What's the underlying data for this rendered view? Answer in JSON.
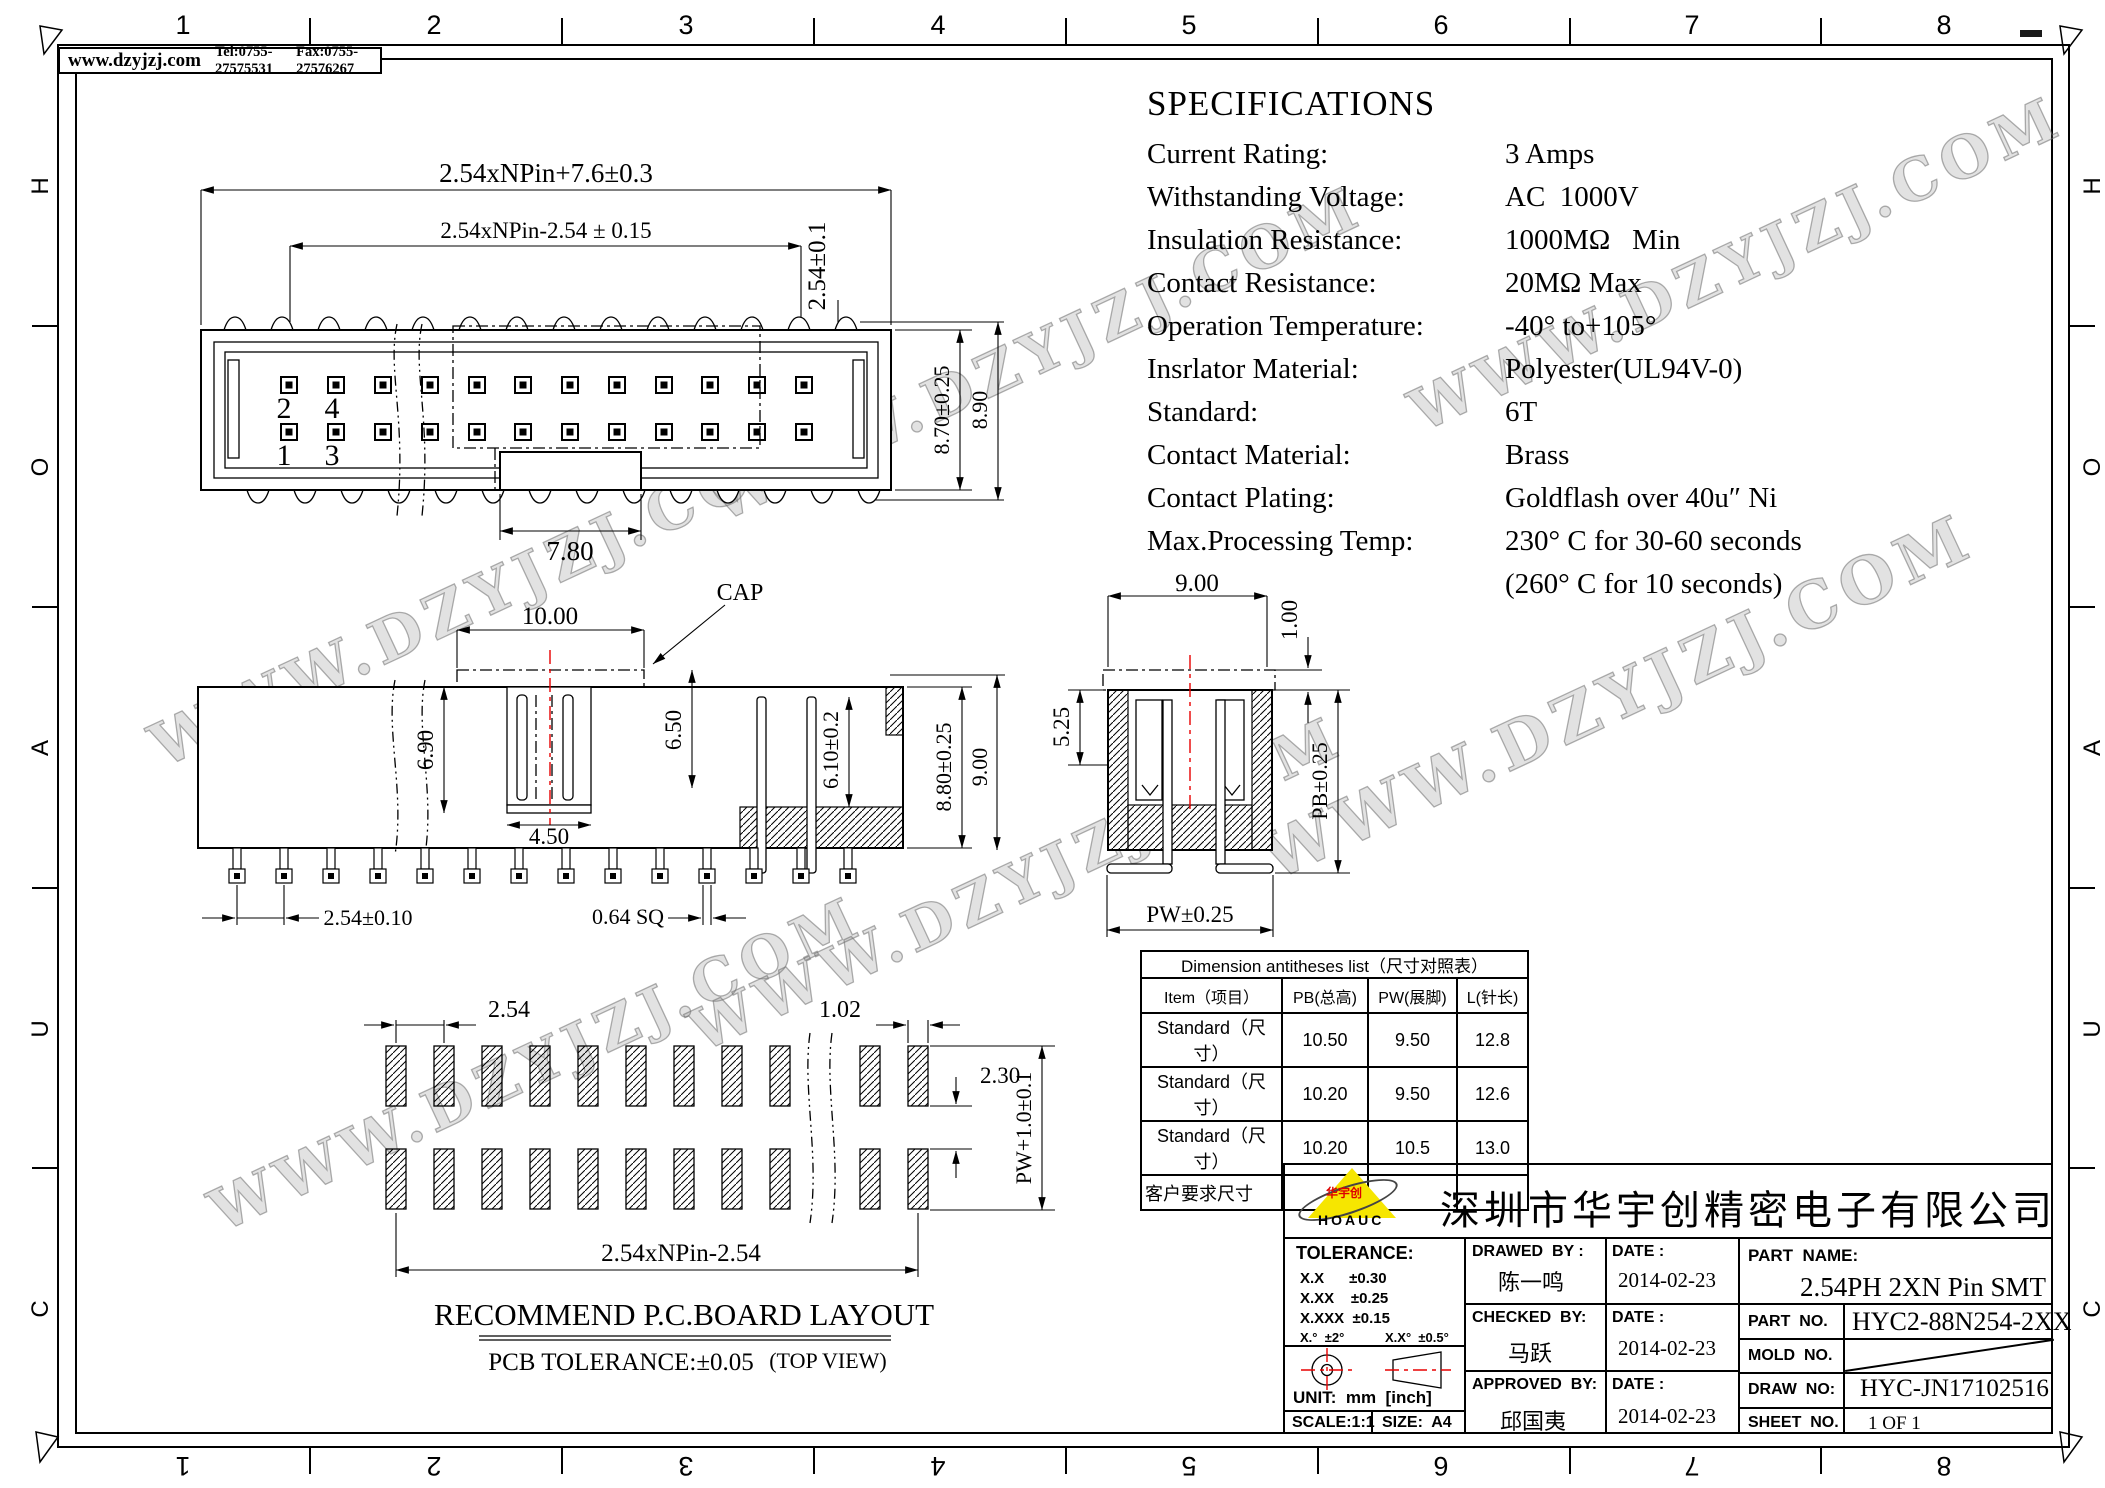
{
  "header": {
    "website": "www.dzyjzj.com",
    "tel": "Tel:0755-27575531",
    "fax": "Fax:0755-27576267"
  },
  "frame": {
    "top_numbers": [
      "1",
      "2",
      "3",
      "4",
      "5",
      "6",
      "7",
      "8"
    ],
    "bottom_numbers": [
      "8",
      "7",
      "6",
      "5",
      "4",
      "3",
      "2",
      "1"
    ],
    "left_letters": [
      "H",
      "O",
      "A",
      "U",
      "C"
    ],
    "right_let": [
      "H",
      "O",
      "A",
      "U",
      "C"
    ]
  },
  "watermark": {
    "text": "WWW.DZYJZJ.COM"
  },
  "specs": {
    "title": "SPECIFICATIONS",
    "rows": [
      {
        "label": "Current Rating:",
        "value": "3 Amps"
      },
      {
        "label": "Withstanding Voltage:",
        "value": "AC  1000V"
      },
      {
        "label": "Insulation Resistance:",
        "value": "1000MΩ   Min"
      },
      {
        "label": "Contact Resistance:",
        "value": "20MΩ Max"
      },
      {
        "label": "Operation Temperature:",
        "value": "-40° to+105°"
      },
      {
        "label": "Insrlator Material:",
        "value": "Polyester(UL94V-0)"
      },
      {
        "label": "Standard:",
        "value": "6T"
      },
      {
        "label": "Contact Material:",
        "value": "Brass"
      },
      {
        "label": "Contact Plating:",
        "value": "Goldflash over 40u″ Ni"
      },
      {
        "label": "Max.Processing Temp:",
        "value": "230° C for 30-60 seconds"
      },
      {
        "label": "",
        "value": "(260° C for 10 seconds)"
      }
    ]
  },
  "top_view": {
    "d_total": "2.54xNPin+7.6±0.3",
    "d_inner": "2.54xNPin-2.54 ± 0.15",
    "d_row_pitch": "2.54±0.1",
    "d_body_h": "8.70±0.25",
    "d_total_h": "8.90",
    "d_tab": "7.80",
    "pins": [
      "2",
      "4",
      "1",
      "3"
    ]
  },
  "side_view": {
    "cap_label": "CAP",
    "d_cap_w": "10.00",
    "d_inner_h": "6.90",
    "d_cap_h": "6.50",
    "d_key_w": "4.50",
    "d_cavity_h": "6.10±0.2",
    "d_body_h": "8.80±0.25",
    "d_total_h": "9.00",
    "d_pitch": "2.54±0.10",
    "d_pin_sq": "0.64 SQ"
  },
  "end_view": {
    "d_width": "9.00",
    "d_cap_t": "1.00",
    "d_step": "5.25",
    "d_pb": "PB±0.25",
    "d_pw": "PW±0.25"
  },
  "pcb": {
    "d_pitch": "2.54",
    "d_pad_w": "1.02",
    "d_gap": "2.30",
    "d_pw": "PW+1.0±0.1",
    "d_total": "2.54xNPin-2.54",
    "title": "RECOMMEND P.C.BOARD LAYOUT",
    "tolerance": "PCB TOLERANCE:±0.05",
    "view_note": "(TOP VIEW)"
  },
  "dim_table": {
    "title": "Dimension antitheses list（尺寸对照表）",
    "columns": [
      "Item（项目）",
      "PB(总高)",
      "PW(展脚)",
      "L(针长)"
    ],
    "rows": [
      [
        "Standard（尺寸）",
        "10.50",
        "9.50",
        "12.8"
      ],
      [
        "Standard（尺寸）",
        "10.20",
        "9.50",
        "12.6"
      ],
      [
        "Standard（尺寸）",
        "10.20",
        "10.5",
        "13.0"
      ],
      [
        "客户要求尺寸",
        "",
        "",
        ""
      ]
    ]
  },
  "title_block": {
    "company": "深圳市华宇创精密电子有限公司",
    "logo_text": "HOAUC",
    "logo_cn": "华宇创",
    "tolerance_title": "TOLERANCE:",
    "tol1": "X.X      ±0.30",
    "tol2": "X.XX    ±0.25",
    "tol3": "X.XXX  ±0.15",
    "tol_ang1": "X.°  ±2°",
    "tol_ang2": "X.X°  ±0.5°",
    "unit": "UNIT:  mm  [inch]",
    "scale": "SCALE:1:1",
    "size": "SIZE:  A4",
    "drawed_by_label": "DRAWED  BY :",
    "drawed_by": "陈一鸣",
    "checked_by_label": "CHECKED  BY:",
    "checked_by": "马跃",
    "approved_by_label": "APPROVED  BY:",
    "approved_by": "邱国夷",
    "date_label": "DATE :",
    "date1": "2014-02-23",
    "date2": "2014-02-23",
    "date3": "2014-02-23",
    "part_name_label": "PART  NAME:",
    "part_name": "2.54PH 2XN Pin SMT",
    "part_no_label": "PART  NO.",
    "part_no": "HYC2-88N254-2XX",
    "mold_no_label": "MOLD  NO.",
    "draw_no_label": "DRAW  NO:",
    "draw_no": "HYC-JN17102516",
    "sheet_no_label": "SHEET  NO.",
    "sheet_no": "1 OF 1"
  }
}
